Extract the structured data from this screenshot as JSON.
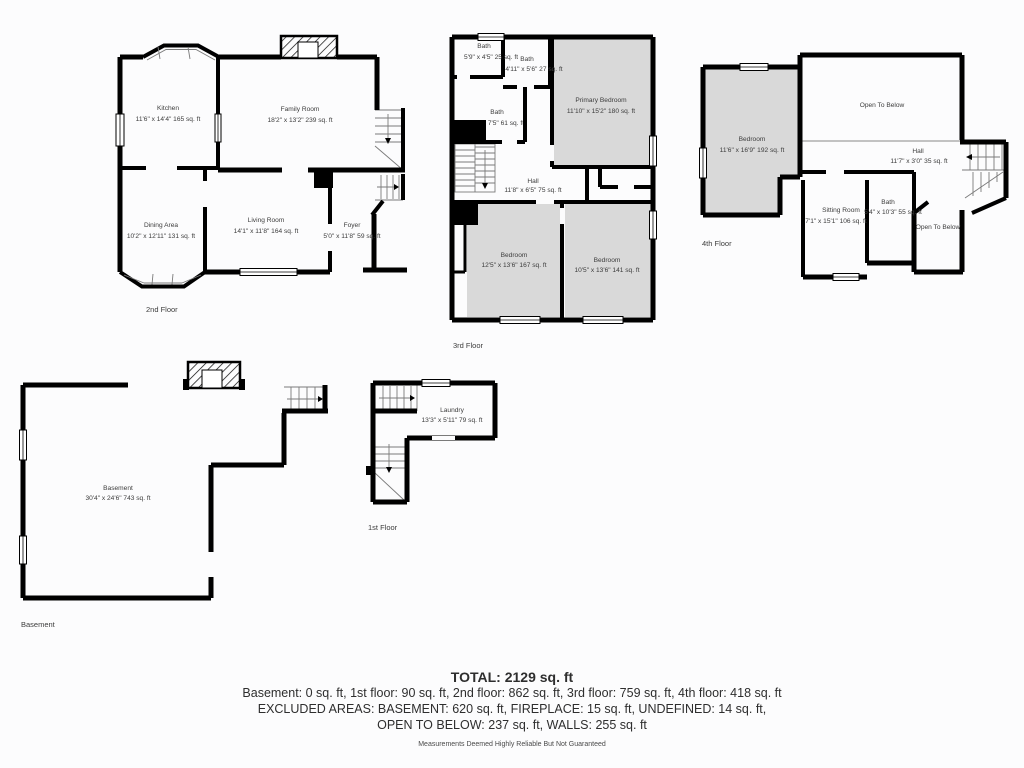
{
  "colors": {
    "background": "#fcfcfd",
    "wall": "#000000",
    "shaded_room_fill": "#d9d9d9",
    "room_fill": "#ffffff",
    "label_text": "#3c3c3c",
    "footer_text": "#2e2e2e"
  },
  "floors": {
    "f2": {
      "label": "2nd Floor",
      "rooms": {
        "kitchen": {
          "name": "Kitchen",
          "dims": "11'6\" x 14'4\" 165 sq. ft"
        },
        "family": {
          "name": "Family Room",
          "dims": "18'2\" x 13'2\" 239 sq. ft"
        },
        "dining": {
          "name": "Dining Area",
          "dims": "10'2\" x 12'11\" 131 sq. ft"
        },
        "living": {
          "name": "Living Room",
          "dims": "14'1\" x 11'8\" 164 sq. ft"
        },
        "foyer": {
          "name": "Foyer",
          "dims": "5'0\" x 11'8\" 59 sq. ft"
        }
      }
    },
    "f3": {
      "label": "3rd Floor",
      "rooms": {
        "bath1": {
          "name": "Bath",
          "dims": "5'9\" x 4'5\" 25 sq. ft"
        },
        "bath2": {
          "name": "Bath",
          "dims": "4'11\" x 5'6\" 27 sq. ft"
        },
        "bath3": {
          "name": "Bath",
          "dims": "8'3\" x 7'5\" 61 sq. ft"
        },
        "primary": {
          "name": "Primary Bedroom",
          "dims": "11'10\" x 15'2\" 180 sq. ft"
        },
        "hall": {
          "name": "Hall",
          "dims": "11'8\" x 6'5\" 75 sq. ft"
        },
        "bedroom1": {
          "name": "Bedroom",
          "dims": "12'5\" x 13'6\" 167 sq. ft"
        },
        "bedroom2": {
          "name": "Bedroom",
          "dims": "10'5\" x 13'6\" 141 sq. ft"
        }
      }
    },
    "f4": {
      "label": "4th Floor",
      "rooms": {
        "bedroom": {
          "name": "Bedroom",
          "dims": "11'6\" x 16'9\" 192 sq. ft"
        },
        "open_top": {
          "name": "Open To Below"
        },
        "hall": {
          "name": "Hall",
          "dims": "11'7\" x 3'0\" 35 sq. ft"
        },
        "sitting": {
          "name": "Sitting Room",
          "dims": "7'1\" x 15'1\" 106 sq. ft"
        },
        "bath": {
          "name": "Bath",
          "dims": "5'4\" x 10'3\" 55 sq. ft"
        },
        "open_bottom": {
          "name": "Open To Below"
        }
      }
    },
    "f1": {
      "label": "1st Floor",
      "rooms": {
        "laundry": {
          "name": "Laundry",
          "dims": "13'3\" x 5'11\" 79 sq. ft"
        }
      }
    },
    "basement": {
      "label": "Basement",
      "rooms": {
        "main": {
          "name": "Basement",
          "dims": "30'4\" x 24'6\" 743 sq. ft"
        }
      }
    }
  },
  "footer": {
    "total": "TOTAL: 2129 sq. ft",
    "line1": "Basement: 0 sq. ft, 1st floor: 90 sq. ft, 2nd floor: 862 sq. ft, 3rd floor: 759 sq. ft, 4th floor: 418 sq. ft",
    "line2": "EXCLUDED AREAS: BASEMENT: 620 sq. ft, FIREPLACE: 15 sq. ft, UNDEFINED: 14 sq. ft,",
    "line3": "OPEN TO BELOW: 237 sq. ft, WALLS: 255 sq. ft",
    "disclaimer": "Measurements Deemed Highly Reliable But Not Guaranteed"
  }
}
